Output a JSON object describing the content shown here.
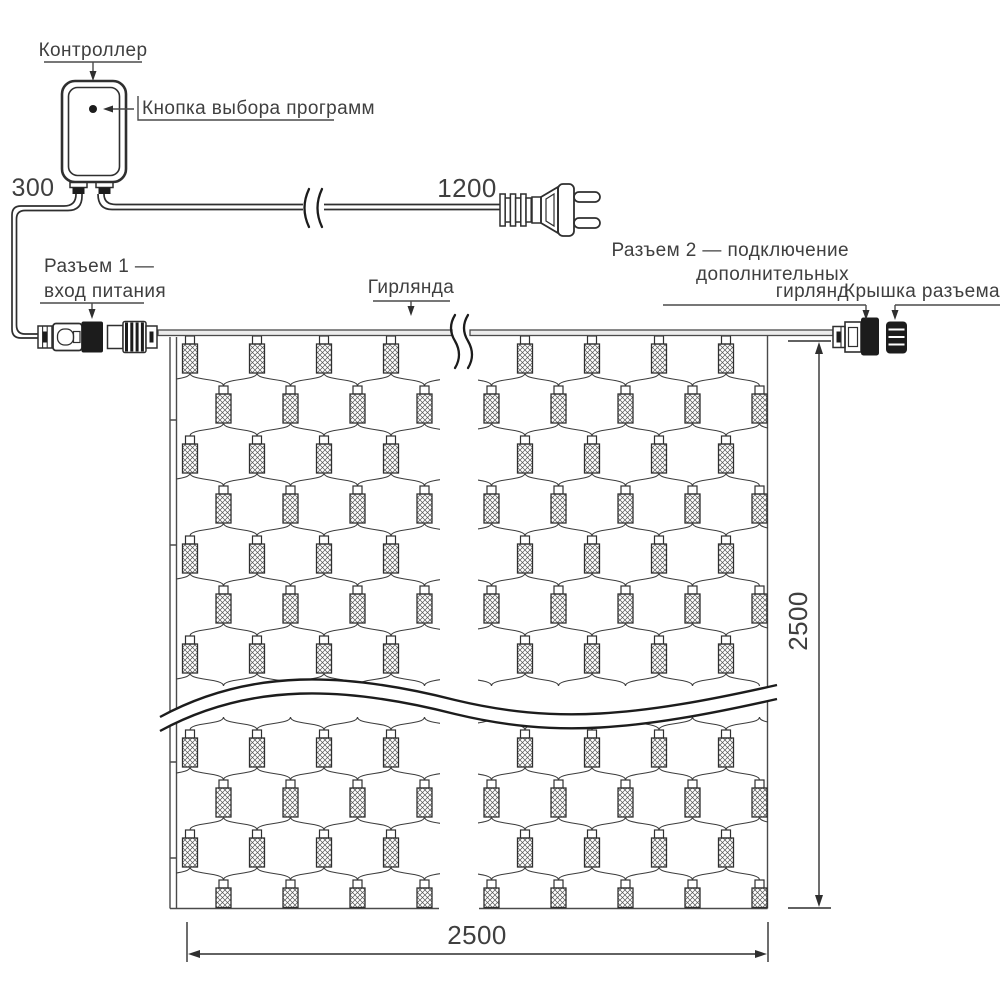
{
  "labels": {
    "controller": "Контроллер",
    "button": "Кнопка выбора программ",
    "connector1_line1": "Разъем 1 —",
    "connector1_line2": "вход питания",
    "garland": "Гирлянда",
    "connector2_line1": "Разъем 2 — подключение",
    "connector2_line2": "дополнительных",
    "connector2_line3": "гирлянд",
    "cap": "Крышка разъема"
  },
  "dims": {
    "controller_lead": "300",
    "power_cord": "1200",
    "height": "2500",
    "width": "2500"
  },
  "colors": {
    "line": "#2f2f2f",
    "dark_fill": "#1c1c1c",
    "text": "#3f3f3f",
    "background": "#ffffff"
  }
}
